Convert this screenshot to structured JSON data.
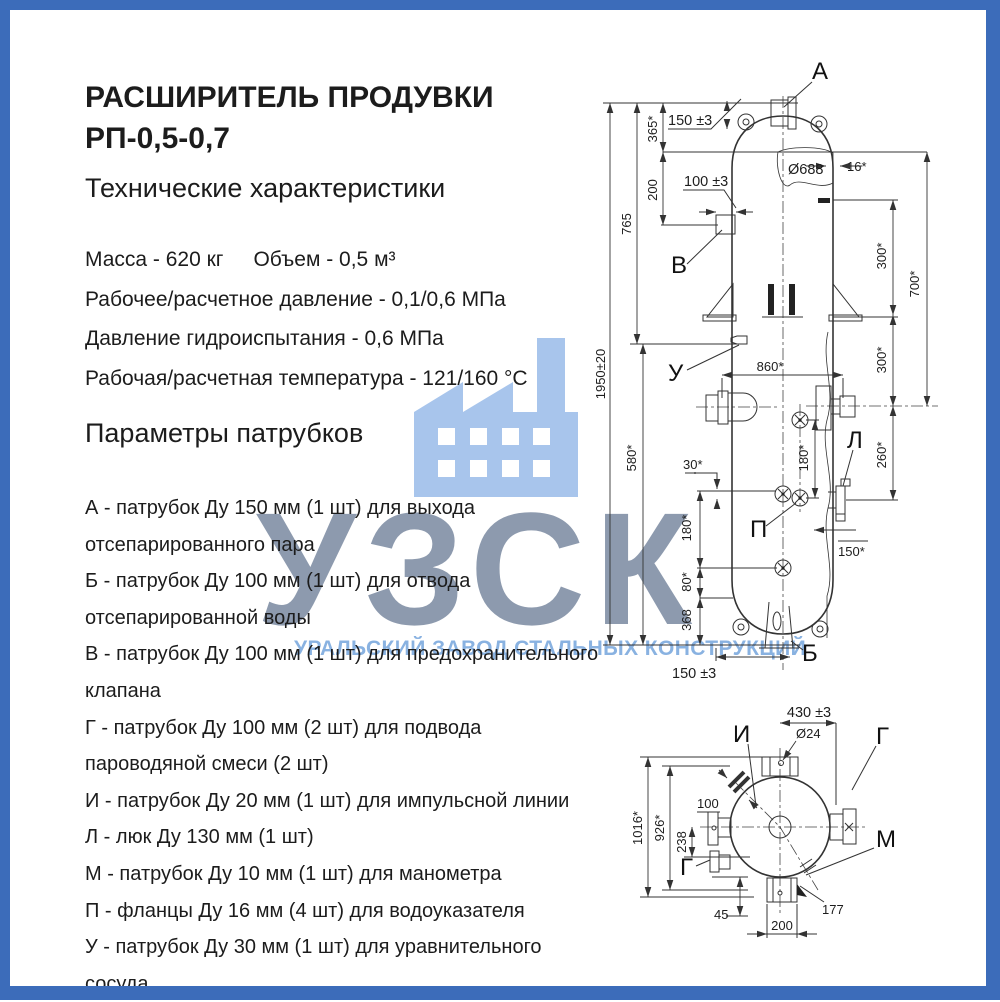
{
  "title": {
    "line1": "РАСШИРИТЕЛЬ ПРОДУВКИ",
    "line2": "РП-0,5-0,7"
  },
  "headings": {
    "specs": "Технические характеристики",
    "nozzles": "Параметры патрубков"
  },
  "specs": {
    "mass": "Масса - 620 кг",
    "volume": "Объем - 0,5 м³",
    "pressure": "Рабочее/расчетное давление - 0,1/0,6 МПа",
    "hydro": "Давление гидроиспытания - 0,6 МПа",
    "temperature": "Рабочая/расчетная температура - 121/160 °С"
  },
  "nozzles": [
    "А - патрубок Ду 150 мм (1 шт) для выхода отсепарированного пара",
    "Б - патрубок Ду 100 мм (1 шт)  для отвода отсепарированной воды",
    "В - патрубок Ду 100 мм (1 шт) для предохранительного клапана",
    "Г - патрубок Ду 100 мм (2 шт) для подвода пароводяной смеси (2 шт)",
    "И - патрубок Ду 20 мм (1 шт) для импульсной линии",
    "Л - люк Ду 130 мм (1 шт)",
    "М - патрубок Ду 10 мм (1 шт) для манометра",
    "П - фланцы Ду 16 мм (4 шт) для водоуказателя",
    "У - патрубок Ду 30 мм (1 шт) для уравнительного сосуда"
  ],
  "watermark": {
    "acronym": "УЗСК",
    "subtitle": "УРАЛЬСКИЙ ЗАВОД СТАЛЬНЫХ КОНСТРУКЦИЙ",
    "icon": "factory-icon",
    "colors": {
      "border": "#3c6cba",
      "acronym": "#8593a8",
      "subtitle": "#83aee0",
      "icon": "#a8c5ec"
    }
  },
  "drawing": {
    "front": {
      "labels": {
        "a": "А",
        "b": "Б",
        "v": "В",
        "u": "У",
        "l": "Л",
        "p": "П"
      },
      "dims": {
        "total_height": "1950±20",
        "upper_765": "765",
        "left_580": "580*",
        "top_365": "365*",
        "top_200": "200",
        "nozzle_a_150": "150 ±3",
        "nozzle_v_100": "100 ±3",
        "diameter_688": "Ø688",
        "wall_16": "16*",
        "right_300_upper": "300*",
        "right_300_lower": "300*",
        "right_700": "700*",
        "mid_860": "860*",
        "gauge_180": "180*",
        "luk_260": "260*",
        "offset_30": "30*",
        "left_180": "180*",
        "left_80": "80*",
        "left_368": "368",
        "right_150": "150*",
        "bottom_150": "150 ±3"
      }
    },
    "bottom": {
      "labels": {
        "i": "И",
        "g_right": "Г",
        "m": "М",
        "g_left": "Г"
      },
      "dims": {
        "width_430": "430 ±3",
        "hole_24": "Ø24",
        "flange_100": "100",
        "overall_1016": "1016*",
        "inner_926": "926*",
        "offset_238": "238",
        "offset_45": "45",
        "width_200": "200",
        "angle_177": "177"
      }
    }
  }
}
